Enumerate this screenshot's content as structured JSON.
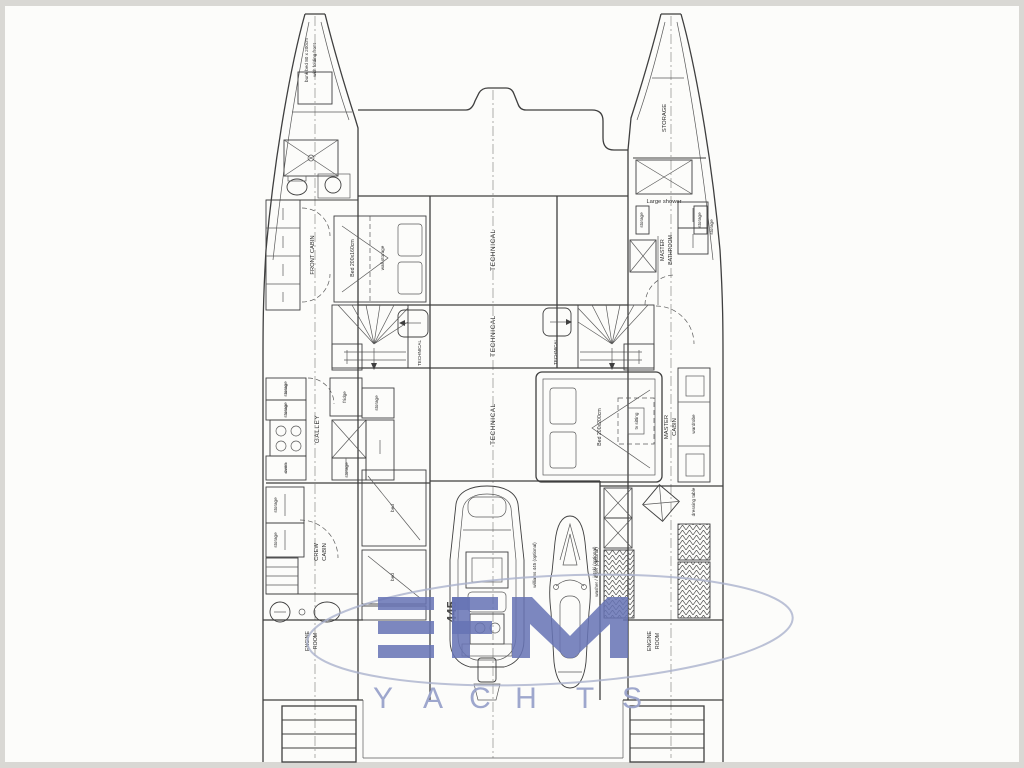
{
  "colors": {
    "accent": "#6773b4",
    "watermark_letters": "#9aa3cb",
    "plan_line": "#3f3f3f",
    "paper": "#fcfcfa"
  },
  "watermark": {
    "letters": [
      "Y",
      "A",
      "C",
      "H",
      "T",
      "S"
    ]
  },
  "labels": {
    "technical": "TECHNICAL",
    "storage": "storage",
    "port": {
      "bow_line1": "bunk bed 80 x 200cm",
      "bow_line2": "with folding front",
      "front_cabin": "FRONT CABIN",
      "bed_size": "Bed 200x160cm",
      "bed_note": "wall storage",
      "galley": "GALLEY",
      "fridge": "fridge",
      "oven": "oven",
      "crew1": "CREW",
      "crew2": "CABIN",
      "bed": "bed",
      "engine1": "ENGINE",
      "engine2": "ROOM"
    },
    "stbd": {
      "storage_bow": "STORAGE",
      "large_shower": "Large shower",
      "mb1": "MASTER",
      "mb2": "BATHROOM",
      "mc1": "MASTER",
      "mc2": "CABIN",
      "bed_size": "Bed 200x200cm",
      "tv": "tv sitting",
      "wardrobe": "wardrobe",
      "dressing": "dressing table",
      "washer": "washer / dryer (optional)",
      "engine1": "ENGINE",
      "engine2": "ROOM"
    },
    "center": {
      "tender_model": "445",
      "tender": "williams 445 (optional)",
      "jetski": "jetski (optional)"
    }
  }
}
